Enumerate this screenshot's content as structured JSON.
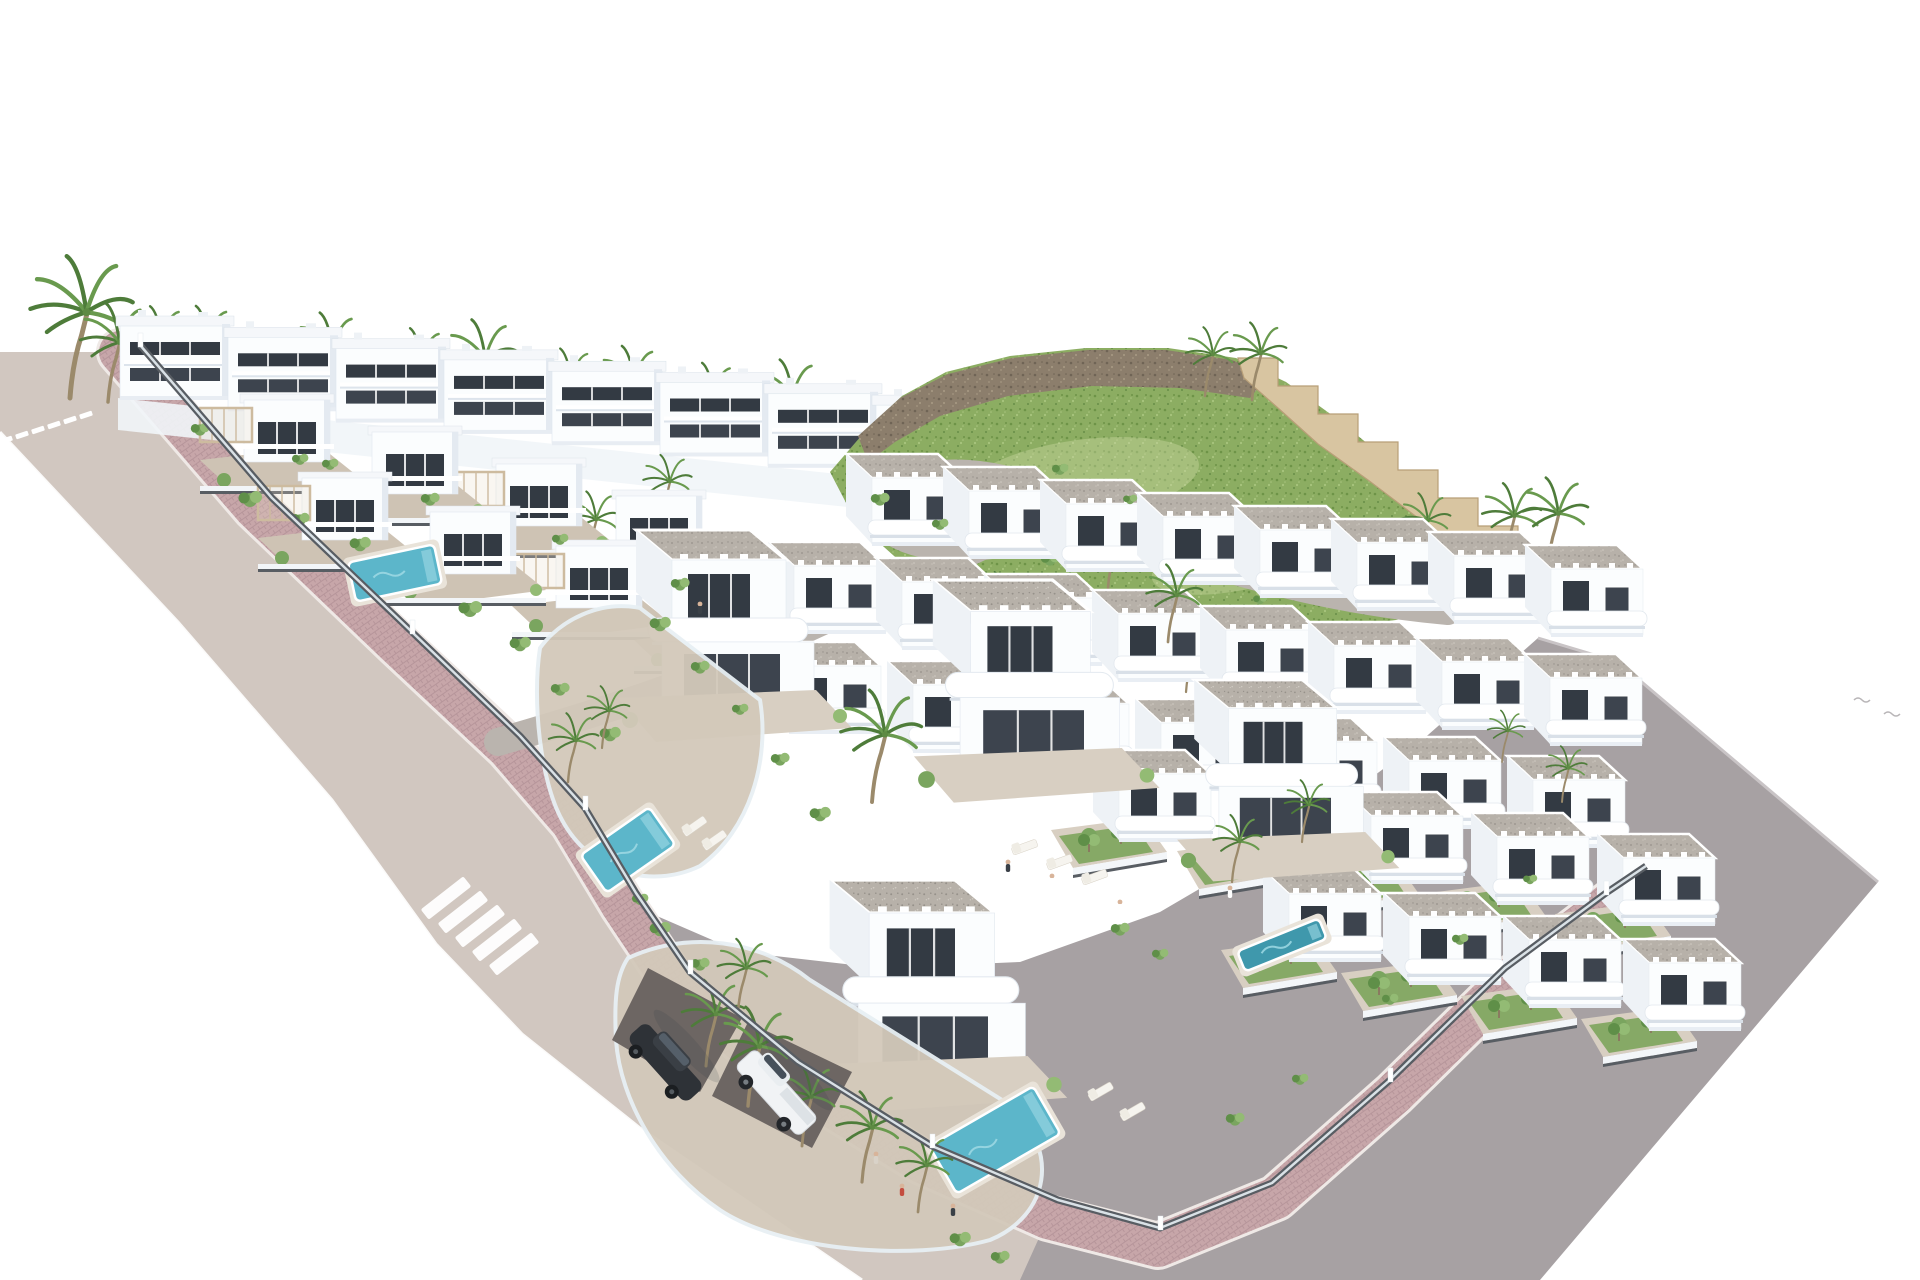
{
  "canvas": {
    "width": 1920,
    "height": 1280
  },
  "palette": {
    "background": "#ffffff",
    "wall_white": "#fbfdfe",
    "wall_shade": "#e4eaf1",
    "wall_side": "#eef2f6",
    "window_dark": "#333a43",
    "window_dark2": "#3d444e",
    "roof_white": "#f5f7fa",
    "gravel": "#b7b1a9",
    "gravel_dot1": "#96918a",
    "gravel_dot2": "#d0cbc3",
    "terrace": "#cec3b4",
    "terrace2": "#d8cfc2",
    "road_beige": "#d1c7c0",
    "road_gray": "#a7a1a3",
    "gray_edge": "#c9c4c6",
    "road_internal": "#bab4ae",
    "brick": "#c7a6a9",
    "brick_line": "#b6959a",
    "brick_edge": "#efe9e6",
    "fence_dark": "#585d63",
    "glass": "#e8f0f4",
    "pool": "#5cb6ca",
    "pool_hi": "#9fd9e4",
    "pool_lap": "#3f98ac",
    "grass": "#8cad62",
    "grass_dot1": "#6d9347",
    "grass_dot2": "#a8c47e",
    "grass_patch": "#cdd9a6",
    "bush1": "#5f8f48",
    "bush2": "#7aa55f",
    "bush3": "#93bb74",
    "rock": "#8c7e6c",
    "rock_dot1": "#6f6455",
    "rock_dot2": "#a59781",
    "stone": "#d8c5a1",
    "stone_line": "#b89f78",
    "palm_frond1": "#4e7c3a",
    "palm_frond2": "#699a4e",
    "trunk": "#9b8a6b",
    "car_dark": "#2e3237",
    "car_white": "#f1f3f5",
    "skin": "#d8b49a",
    "shadow": "rgba(50,60,70,0.15)"
  },
  "scene": {
    "roads": {
      "gray_polygon": [
        [
          620,
          900
        ],
        [
          870,
          1280
        ],
        [
          1540,
          1280
        ],
        [
          1878,
          882
        ],
        [
          1618,
          662
        ],
        [
          1538,
          638
        ],
        [
          1420,
          742
        ],
        [
          1300,
          830
        ],
        [
          1160,
          912
        ],
        [
          1020,
          962
        ],
        [
          880,
          968
        ],
        [
          740,
          952
        ]
      ],
      "gray_edge_line": [
        [
          1538,
          638
        ],
        [
          1618,
          662
        ],
        [
          1878,
          882
        ]
      ],
      "beige_polygon": [
        [
          0,
          352
        ],
        [
          118,
          352
        ],
        [
          255,
          508
        ],
        [
          398,
          645
        ],
        [
          508,
          748
        ],
        [
          572,
          822
        ],
        [
          622,
          905
        ],
        [
          676,
          986
        ],
        [
          786,
          1078
        ],
        [
          922,
          1162
        ],
        [
          1048,
          1218
        ],
        [
          1020,
          1280
        ],
        [
          862,
          1280
        ],
        [
          640,
          1128
        ],
        [
          522,
          1034
        ],
        [
          436,
          944
        ],
        [
          332,
          800
        ],
        [
          178,
          622
        ],
        [
          0,
          432
        ]
      ],
      "outer_curb": [
        [
          0,
          432
        ],
        [
          178,
          622
        ],
        [
          332,
          800
        ],
        [
          436,
          944
        ],
        [
          522,
          1034
        ],
        [
          640,
          1128
        ],
        [
          862,
          1280
        ]
      ],
      "culdesac": "M1068,512 C1020,468 912,462 884,498 C864,528 918,550 972,546 C1026,542 1052,530 1072,520",
      "internal": [
        {
          "d": "M1062,508 C960,556 830,620 700,676 C640,700 560,724 498,742",
          "w": 28
        },
        {
          "d": "M1072,516 C1190,562 1310,600 1448,612",
          "w": 26
        }
      ],
      "lane_dashes": {
        "start": [
          6,
          440
        ],
        "step": [
          16,
          -5
        ],
        "n": 6,
        "w": 13,
        "h": 5,
        "rot": -18
      },
      "crosswalk": {
        "start": [
          446,
          898
        ],
        "step": [
          17,
          14
        ],
        "n": 5,
        "w": 54,
        "h": 13,
        "rot": -38
      }
    },
    "sidewalk_points": [
      [
        120,
        352
      ],
      [
        255,
        508
      ],
      [
        398,
        645
      ],
      [
        508,
        748
      ],
      [
        572,
        822
      ],
      [
        622,
        905
      ],
      [
        676,
        986
      ],
      [
        786,
        1078
      ],
      [
        922,
        1162
      ],
      [
        1048,
        1218
      ],
      [
        1158,
        1246
      ],
      [
        1276,
        1198
      ],
      [
        1394,
        1094
      ],
      [
        1510,
        980
      ],
      [
        1612,
        902
      ],
      [
        1652,
        874
      ]
    ],
    "fence_points": [
      [
        140,
        345
      ],
      [
        272,
        498
      ],
      [
        412,
        632
      ],
      [
        520,
        736
      ],
      [
        585,
        808
      ],
      [
        636,
        893
      ],
      [
        690,
        972
      ],
      [
        798,
        1062
      ],
      [
        932,
        1146
      ],
      [
        1058,
        1200
      ],
      [
        1160,
        1228
      ],
      [
        1272,
        1183
      ],
      [
        1390,
        1080
      ],
      [
        1505,
        968
      ],
      [
        1606,
        893
      ],
      [
        1646,
        866
      ]
    ],
    "back_row": {
      "start": [
        118,
        310
      ],
      "step": [
        108,
        11.3
      ],
      "count": 11
    },
    "back_terrace": [
      [
        118,
        398
      ],
      [
        1236,
        516
      ],
      [
        1236,
        548
      ],
      [
        118,
        430
      ]
    ],
    "hill": {
      "body": [
        [
          830,
          472
        ],
        [
          868,
          428
        ],
        [
          902,
          396
        ],
        [
          946,
          372
        ],
        [
          1010,
          356
        ],
        [
          1086,
          348
        ],
        [
          1168,
          348
        ],
        [
          1236,
          358
        ],
        [
          1286,
          382
        ],
        [
          1336,
          418
        ],
        [
          1390,
          462
        ],
        [
          1444,
          512
        ],
        [
          1488,
          552
        ],
        [
          1510,
          578
        ],
        [
          1470,
          602
        ],
        [
          1396,
          620
        ],
        [
          1300,
          632
        ],
        [
          1196,
          640
        ],
        [
          1090,
          638
        ],
        [
          992,
          616
        ],
        [
          912,
          572
        ],
        [
          856,
          522
        ]
      ],
      "ridge": [
        [
          858,
          436
        ],
        [
          900,
          398
        ],
        [
          948,
          374
        ],
        [
          1012,
          358
        ],
        [
          1088,
          350
        ],
        [
          1166,
          350
        ],
        [
          1232,
          360
        ],
        [
          1268,
          376
        ],
        [
          1250,
          398
        ],
        [
          1180,
          388
        ],
        [
          1092,
          386
        ],
        [
          1008,
          396
        ],
        [
          940,
          416
        ],
        [
          895,
          442
        ],
        [
          868,
          462
        ]
      ],
      "rock_patch": [
        [
          912,
          502
        ],
        [
          966,
          488
        ],
        [
          1002,
          506
        ],
        [
          958,
          532
        ],
        [
          916,
          524
        ]
      ],
      "patches": [
        [
          1080,
          480,
          120,
          40,
          -8
        ],
        [
          1240,
          560,
          90,
          30,
          -12
        ]
      ],
      "bushes": [
        [
          950,
          520,
          0.7
        ],
        [
          1050,
          560,
          0.8
        ],
        [
          1150,
          600,
          0.7
        ],
        [
          1260,
          600,
          0.6
        ],
        [
          1340,
          560,
          0.6
        ]
      ]
    },
    "stone_wall": {
      "start": [
        1238,
        358
      ],
      "n": 8,
      "sx": 40,
      "sy": 28,
      "tail": 30,
      "inner": [
        [
          1520,
          590
        ],
        [
          1468,
          554
        ],
        [
          1418,
          518
        ],
        [
          1368,
          480
        ],
        [
          1318,
          444
        ],
        [
          1278,
          408
        ],
        [
          1244,
          378
        ]
      ]
    },
    "palms_back": [
      [
        70,
        398,
        1.65
      ],
      [
        108,
        402,
        1.15
      ],
      [
        152,
        388,
        0.95
      ],
      [
        198,
        392,
        1.0
      ],
      [
        252,
        398,
        0.85
      ],
      [
        322,
        403,
        1.05
      ],
      [
        412,
        410,
        0.95
      ],
      [
        474,
        416,
        1.12
      ],
      [
        562,
        426,
        0.9
      ],
      [
        624,
        432,
        1.0
      ],
      [
        704,
        442,
        0.92
      ],
      [
        782,
        450,
        1.05
      ]
    ],
    "palms_mid": [
      [
        1205,
        396,
        0.8
      ],
      [
        1252,
        400,
        0.9
      ],
      [
        1505,
        565,
        0.95
      ],
      [
        1548,
        568,
        1.05
      ],
      [
        1108,
        588,
        0.85
      ],
      [
        1420,
        562,
        0.8
      ],
      [
        996,
        632,
        0.7
      ],
      [
        662,
        522,
        0.78
      ],
      [
        588,
        562,
        0.82
      ],
      [
        905,
        642,
        0.8
      ],
      [
        1186,
        692,
        0.75
      ]
    ],
    "palms_front": [
      [
        568,
        782,
        0.8
      ],
      [
        602,
        748,
        0.72
      ],
      [
        706,
        1066,
        1.0
      ],
      [
        748,
        1106,
        1.15
      ],
      [
        802,
        1146,
        0.95
      ],
      [
        862,
        1182,
        1.05
      ],
      [
        918,
        1212,
        0.9
      ],
      [
        738,
        1012,
        0.85
      ],
      [
        1168,
        642,
        0.9
      ],
      [
        1232,
        882,
        0.78
      ],
      [
        1302,
        842,
        0.72
      ],
      [
        1502,
        762,
        0.6
      ],
      [
        1562,
        802,
        0.65
      ],
      [
        872,
        802,
        1.3
      ]
    ],
    "center_rows": [
      {
        "start": [
          838,
          452
        ],
        "step": [
          97,
          13
        ],
        "count": 8,
        "garden": false
      },
      {
        "start": [
          760,
          540
        ],
        "step": [
          108,
          16
        ],
        "count": 8,
        "garden": false
      },
      {
        "start": [
          755,
          640
        ],
        "step": [
          124,
          19
        ],
        "count": 7,
        "garden": false
      },
      {
        "start": [
          1085,
          748
        ],
        "step": [
          126,
          21
        ],
        "count": 5,
        "garden": true
      },
      {
        "start": [
          1255,
          868
        ],
        "step": [
          120,
          23
        ],
        "count": 4,
        "garden": true
      }
    ],
    "villa_rows": [
      {
        "symbol": "sym-villa2",
        "positions": [
          [
            200,
            382
          ],
          [
            452,
            446
          ]
        ]
      },
      {
        "symbol": "sym-villa",
        "positions": [
          [
            328,
            414
          ],
          [
            572,
            478
          ]
        ]
      },
      {
        "symbol": "sym-villa2",
        "positions": [
          [
            258,
            460
          ],
          [
            512,
            528
          ]
        ]
      },
      {
        "symbol": "sym-villa",
        "positions": [
          [
            386,
            494
          ],
          [
            634,
            562
          ]
        ]
      }
    ],
    "big_villas": [
      [
        600,
        530,
        1.0
      ],
      [
        895,
        580,
        1.05
      ],
      [
        1160,
        680,
        0.95
      ],
      [
        790,
        880,
        1.1
      ]
    ],
    "gardens_big": [
      "M540,648 C560,620 600,600 640,608 L760,700 C770,760 750,830 700,866 C650,890 590,872 562,820 C540,780 532,700 540,648 Z",
      "M628,958 C690,930 760,940 810,980 L1010,1105 C1060,1150 1050,1215 990,1240 C910,1262 780,1250 720,1210 C660,1170 620,1100 616,1040 C614,1000 616,976 628,958 Z"
    ],
    "driveways": [
      [
        [
          648,
          968
        ],
        [
          742,
          1018
        ],
        [
          700,
          1092
        ],
        [
          612,
          1040
        ]
      ],
      [
        [
          748,
          1022
        ],
        [
          852,
          1072
        ],
        [
          812,
          1148
        ],
        [
          712,
          1096
        ]
      ]
    ],
    "pools": [
      {
        "c": [
          395,
          573
        ],
        "w": 88,
        "h": 40,
        "rot": -12,
        "lap": false
      },
      {
        "c": [
          628,
          850
        ],
        "w": 84,
        "h": 46,
        "rot": -35,
        "lap": false
      },
      {
        "c": [
          995,
          1140
        ],
        "w": 120,
        "h": 55,
        "rot": -30,
        "lap": false
      },
      {
        "c": [
          1282,
          945
        ],
        "w": 88,
        "h": 22,
        "rot": -22,
        "lap": true
      }
    ],
    "loungers": [
      [
        680,
        828,
        -35
      ],
      [
        700,
        842,
        -35
      ],
      [
        1086,
        1092,
        -30
      ],
      [
        1118,
        1112,
        -30
      ],
      [
        1010,
        845,
        -20
      ],
      [
        1045,
        860,
        -20
      ],
      [
        1080,
        875,
        -20
      ]
    ],
    "bushes": [
      [
        250,
        500,
        1
      ],
      [
        300,
        520,
        0.8
      ],
      [
        360,
        545,
        0.9
      ],
      [
        420,
        575,
        0.8
      ],
      [
        470,
        610,
        1
      ],
      [
        520,
        645,
        0.9
      ],
      [
        560,
        690,
        0.8
      ],
      [
        610,
        735,
        0.9
      ],
      [
        300,
        460,
        0.7
      ],
      [
        430,
        500,
        0.8
      ],
      [
        560,
        540,
        0.7
      ],
      [
        680,
        585,
        0.8
      ],
      [
        200,
        430,
        0.8
      ],
      [
        330,
        465,
        0.7
      ],
      [
        660,
        625,
        0.9
      ],
      [
        700,
        668,
        0.8
      ],
      [
        740,
        710,
        0.7
      ],
      [
        780,
        760,
        0.8
      ],
      [
        820,
        815,
        0.9
      ],
      [
        660,
        930,
        0.9
      ],
      [
        700,
        965,
        0.8
      ],
      [
        640,
        900,
        0.7
      ],
      [
        1120,
        930,
        0.8
      ],
      [
        1160,
        955,
        0.7
      ],
      [
        960,
        1240,
        0.9
      ],
      [
        1000,
        1258,
        0.8
      ],
      [
        1235,
        1120,
        0.8
      ],
      [
        1300,
        1080,
        0.7
      ],
      [
        1390,
        1000,
        0.7
      ],
      [
        1460,
        940,
        0.7
      ],
      [
        1530,
        880,
        0.6
      ],
      [
        880,
        500,
        0.8
      ],
      [
        940,
        525,
        0.7
      ],
      [
        1060,
        470,
        0.7
      ],
      [
        1130,
        500,
        0.6
      ]
    ],
    "cars": [
      {
        "type": "dark",
        "c": [
          700,
          1034
        ],
        "rot": 48,
        "s": 1.0
      },
      {
        "type": "white",
        "c": [
          812,
          1062
        ],
        "rot": 48,
        "s": 1.05
      }
    ],
    "people": [
      [
        1008,
        862,
        "#3a4047"
      ],
      [
        1052,
        876,
        "#ffffff"
      ],
      [
        902,
        1186,
        "#c44d3f"
      ],
      [
        953,
        1206,
        "#3a4047"
      ],
      [
        1120,
        902,
        "#ffffff"
      ],
      [
        700,
        604,
        "#3a4047"
      ],
      [
        1230,
        888,
        "#ffffff"
      ],
      [
        876,
        1154,
        "#d9d2c8"
      ]
    ],
    "birds": [
      [
        1854,
        700
      ],
      [
        1884,
        714
      ]
    ]
  }
}
